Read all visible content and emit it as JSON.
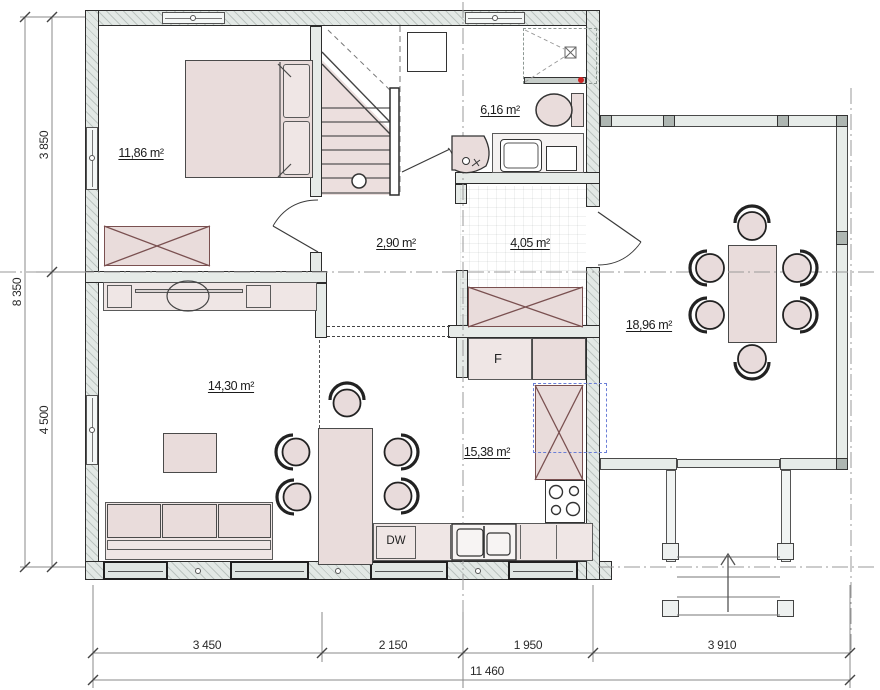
{
  "rooms": {
    "bedroom": {
      "area": "11,86 m²"
    },
    "bathroom": {
      "area": "6,16 m²"
    },
    "hall": {
      "area": "2,90 m²"
    },
    "entry": {
      "area": "4,05 m²"
    },
    "dining": {
      "area": "18,96 m²"
    },
    "living": {
      "area": "14,30 m²"
    },
    "kitchen": {
      "area": "15,38 m²"
    }
  },
  "appliances": {
    "fridge": "F",
    "dishwasher": "DW"
  },
  "dimensions": {
    "left": {
      "total": "8 350",
      "top": "3 850",
      "bottom": "4 500"
    },
    "bottom": {
      "segments": [
        "3 450",
        "2 150",
        "1 950",
        "3 910"
      ],
      "total": "11 460"
    }
  },
  "colors": {
    "wall_fill": "#e2e8e5",
    "furniture_fill": "#e9dcdb",
    "stair_fill": "#ecdfde",
    "accent_dashed": "#6b7fd7",
    "alarm_dot": "#cc2222"
  }
}
